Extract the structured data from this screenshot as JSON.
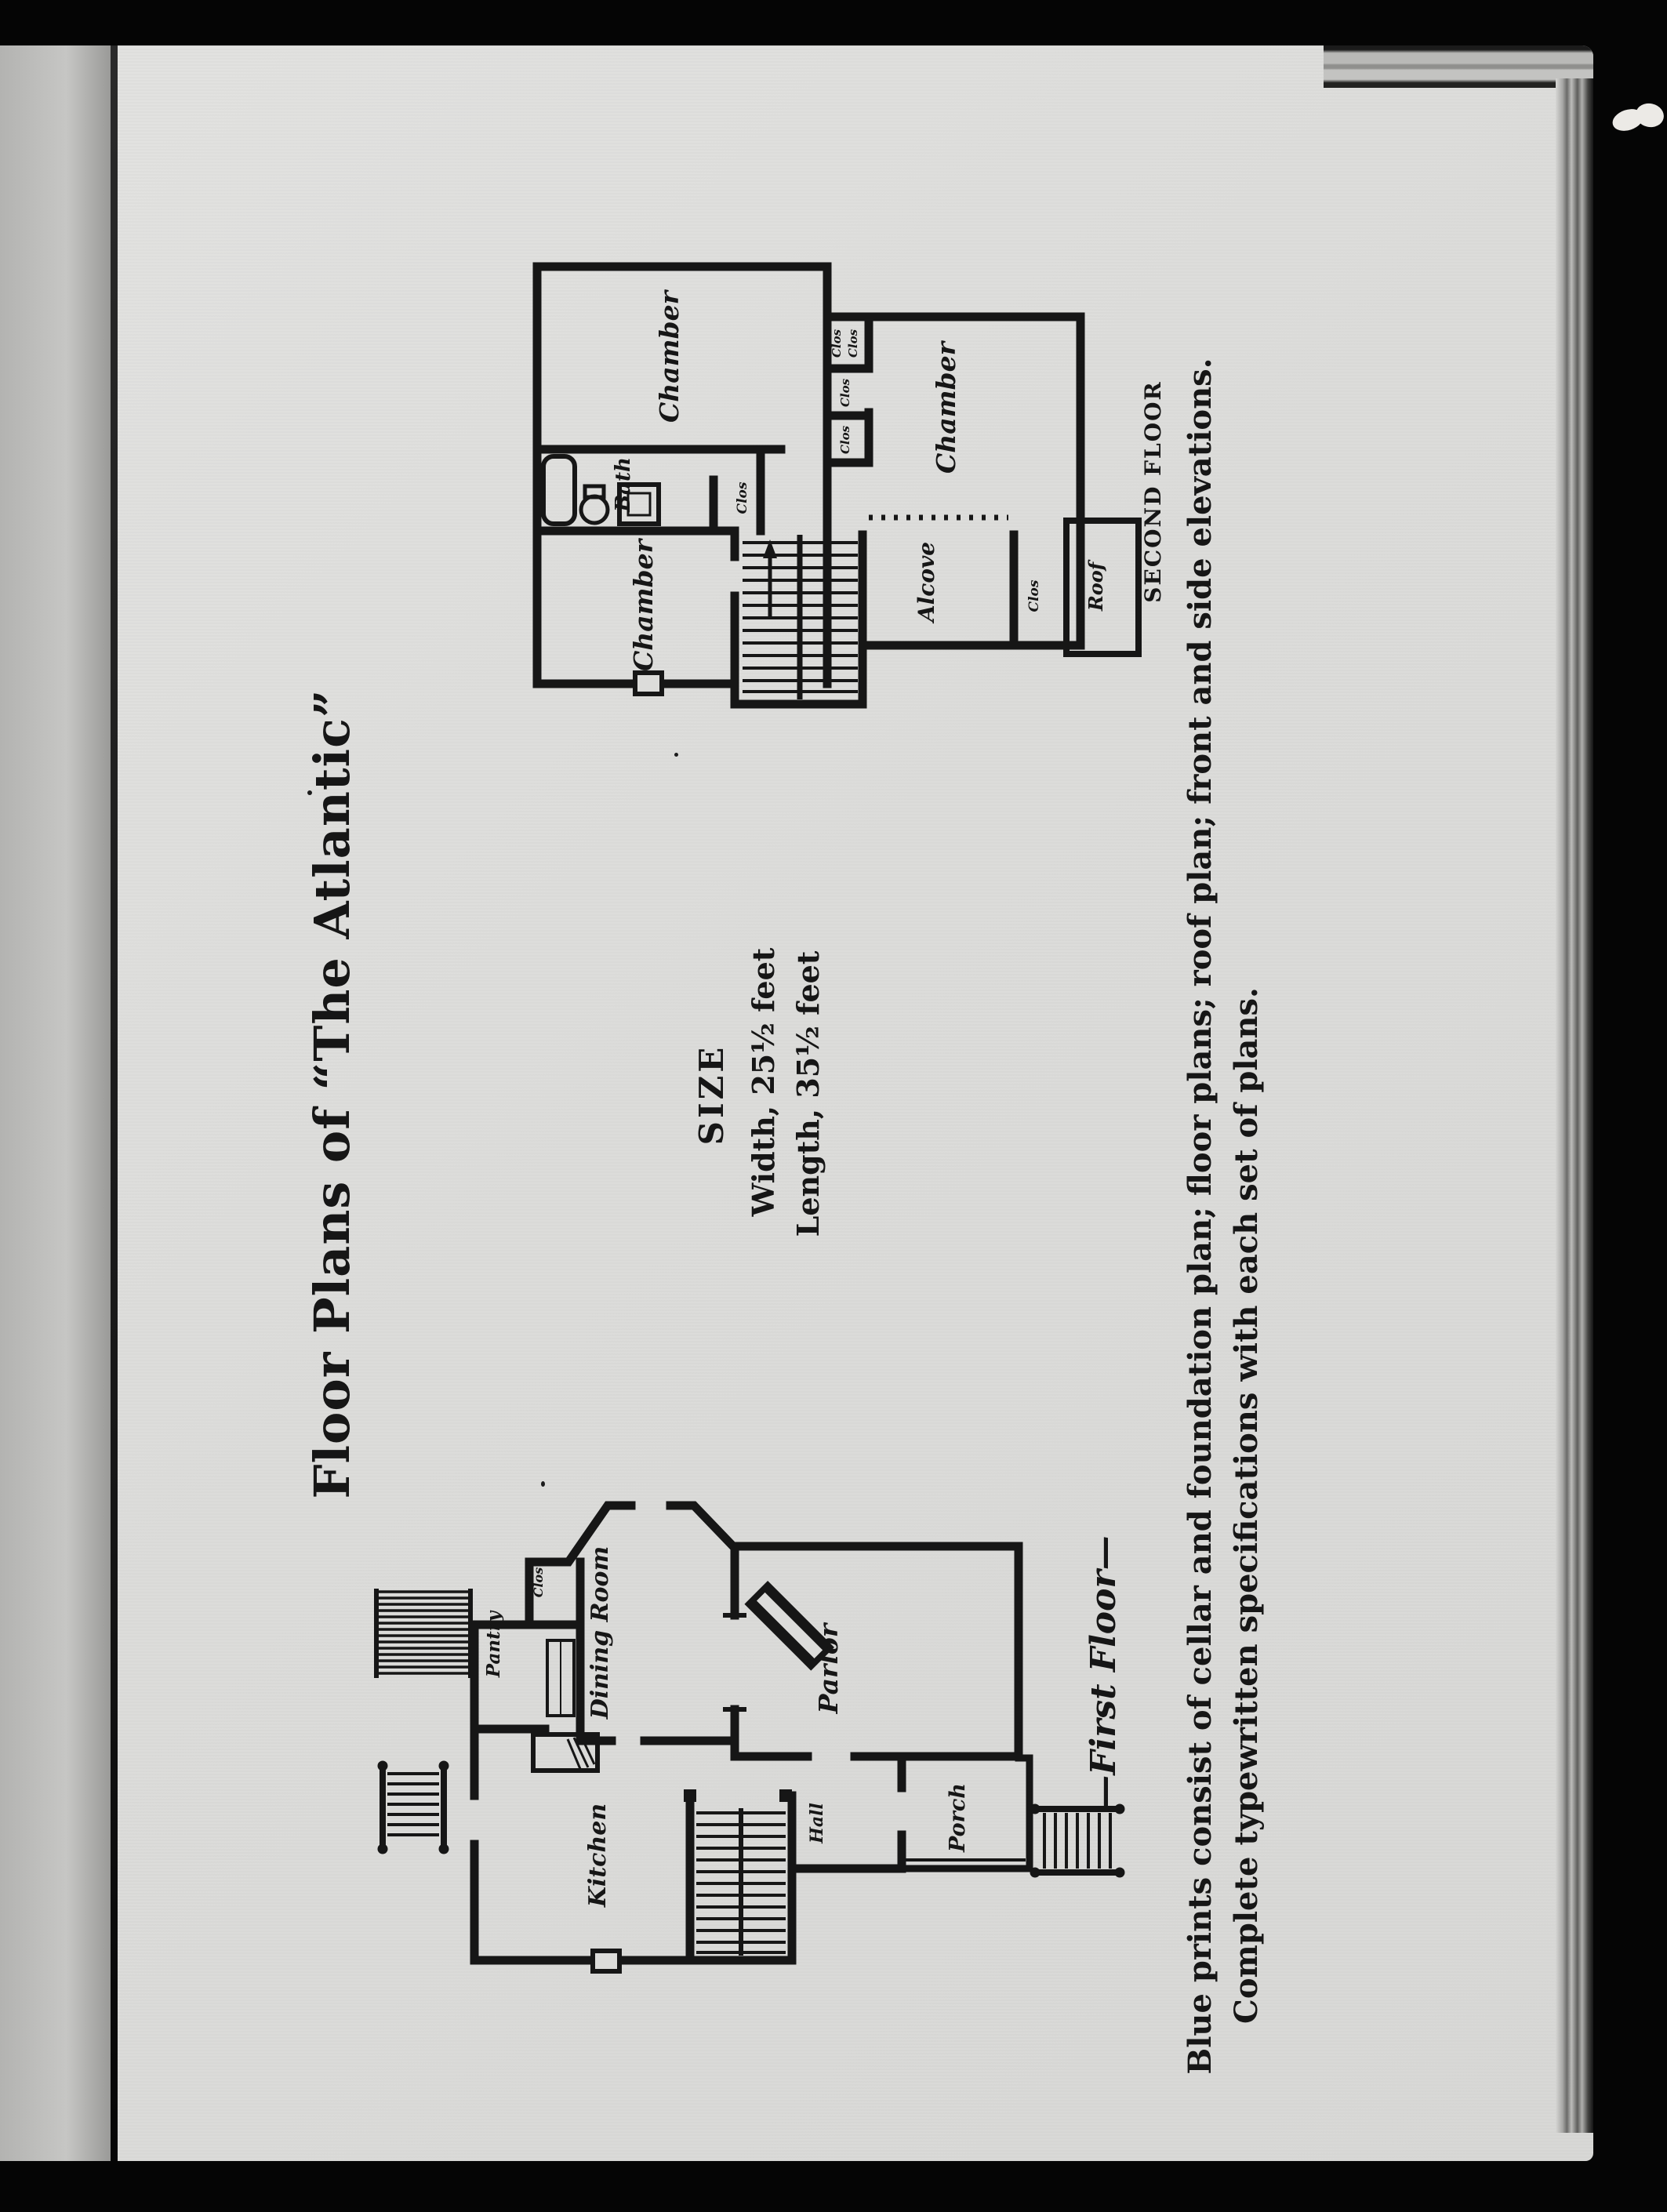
{
  "document": {
    "title": "Floor Plans of “The Atlantic”",
    "size": {
      "heading": "SIZE",
      "width_line": "Width, 25½ feet",
      "length_line": "Length, 35½ feet"
    },
    "footer": {
      "line1": "Blue prints consist of cellar and foundation plan; floor plans; roof plan; front and side elevations.",
      "line2": "Complete typewritten specifications with each set of plans."
    }
  },
  "second_floor": {
    "caption": "SECOND FLOOR",
    "rooms": {
      "chamber_top": "Chamber",
      "chamber_right": "Chamber",
      "chamber_bottom": "Chamber",
      "bath": "Bath",
      "alcove": "Alcove",
      "roof": "Roof"
    },
    "closets": [
      "Clos",
      "Clos",
      "Clos",
      "Clos",
      "Clos",
      "Clos"
    ]
  },
  "first_floor": {
    "caption": "—First Floor—",
    "rooms": {
      "clos": "Clos",
      "pantry": "Pantry",
      "dining_room": "Dining Room",
      "kitchen": "Kitchen",
      "parlor": "Parlor",
      "hall": "Hall",
      "porch": "Porch"
    }
  },
  "colors": {
    "paper": "#dcdcda",
    "ink": "#161616",
    "backdrop": "#050505"
  }
}
